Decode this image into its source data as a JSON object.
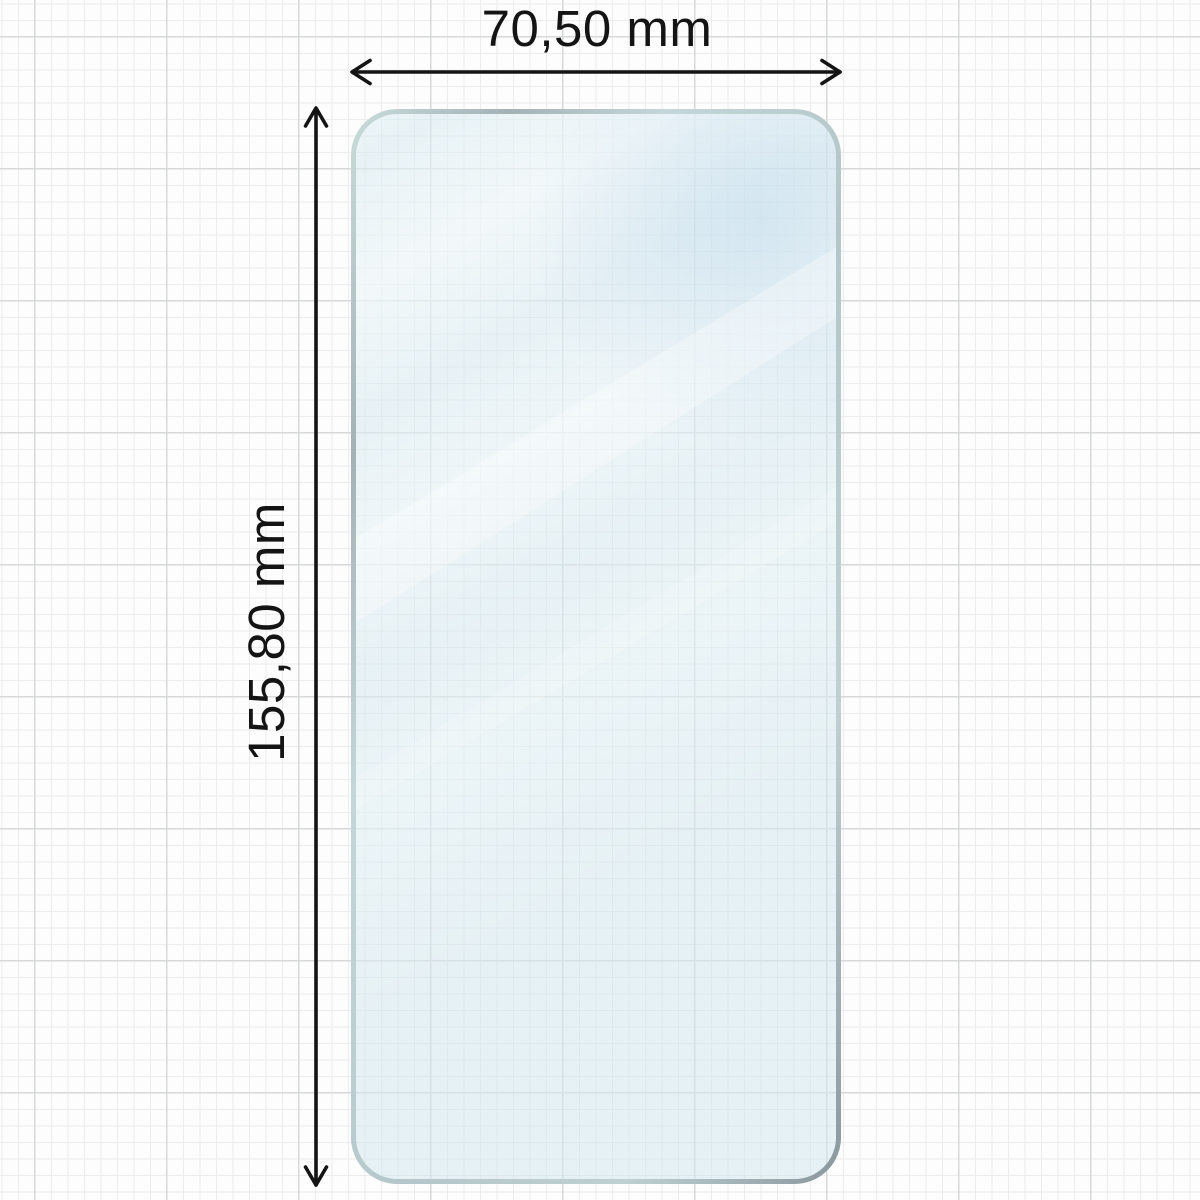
{
  "diagram": {
    "type": "screen-protector-dimension-diagram",
    "width": {
      "label": "70,50 mm"
    },
    "height": {
      "label": "155,80 mm"
    },
    "colors": {
      "dimension_line": "#141414",
      "label_text": "#141414",
      "glass_tint": "#e9f3f7",
      "glass_edge_light": "#c9dcda",
      "glass_edge_dark": "#8a989e",
      "grid_minor": "#ececec",
      "grid_major": "#d7d9d9",
      "background": "#fdfdfd"
    }
  }
}
